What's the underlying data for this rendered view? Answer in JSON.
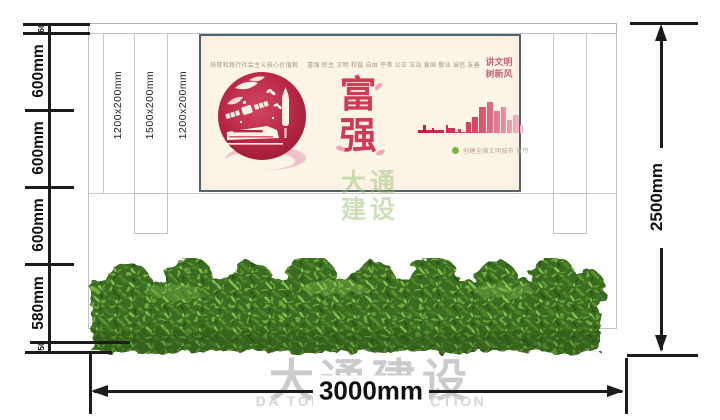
{
  "drawing": {
    "left_chain": [
      "60",
      "600mm",
      "600mm",
      "600mm",
      "580mm",
      "50"
    ],
    "total_height": "2500mm",
    "total_width": "3000mm",
    "panel_labels": [
      "1200x200mm",
      "1500x200mm",
      "1200x200mm"
    ]
  },
  "poster": {
    "header_text": "培育和践行社会主义核心价值观",
    "values_text": "富强 民主 文明 和谐 自由 平等 公正 法治 爱国 敬业 诚信 友善",
    "main_char_1": "富",
    "main_char_2": "强",
    "slogan_line1": "讲文明",
    "slogan_line2": "树新风",
    "badge_text": "创建全国文明城市 宣传",
    "colors": {
      "poster_background": "#fdf4e8",
      "accent_red": "#cf3a54",
      "circle_crimson": "#b82846",
      "slogan_pink": "#c4677a",
      "skyline_gradient_start": "#bb1d3c",
      "skyline_gradient_end": "#f4c7d1",
      "badge_green": "#7cb83d",
      "frame_gray": "#52636b"
    }
  },
  "watermark": {
    "cn_line1": "大通",
    "cn_line2": "建设",
    "cn_full": "大通建设",
    "en_full": "DA TONG CONSTRUCTION"
  }
}
